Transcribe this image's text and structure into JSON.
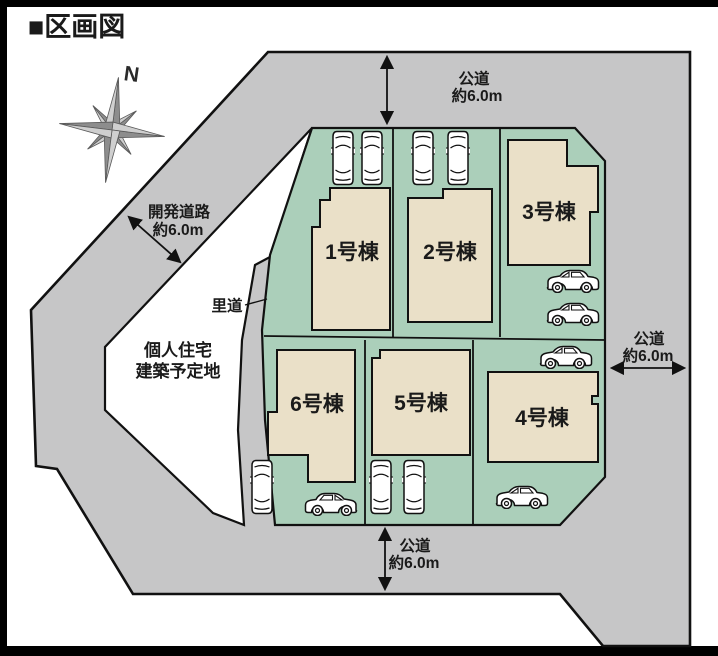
{
  "title": "■区画図",
  "compass": {
    "north": "N"
  },
  "roads": {
    "top": {
      "name": "公道",
      "width": "約6.0m"
    },
    "right": {
      "name": "公道",
      "width": "約6.0m"
    },
    "bottom": {
      "name": "公道",
      "width": "約6.0m"
    },
    "development": {
      "name": "開発道路",
      "width": "約6.0m"
    },
    "village": {
      "name": "里道"
    }
  },
  "private_site": {
    "line1": "個人住宅",
    "line2": "建築予定地"
  },
  "lots": [
    {
      "label": "1号棟"
    },
    {
      "label": "2号棟"
    },
    {
      "label": "3号棟"
    },
    {
      "label": "4号棟"
    },
    {
      "label": "5号棟"
    },
    {
      "label": "6号棟"
    }
  ],
  "colors": {
    "road": "#c6c6c7",
    "plot": "#abcfba",
    "building": "#eae0c8",
    "outline": "#1a1a1a",
    "frame": "#000000"
  }
}
